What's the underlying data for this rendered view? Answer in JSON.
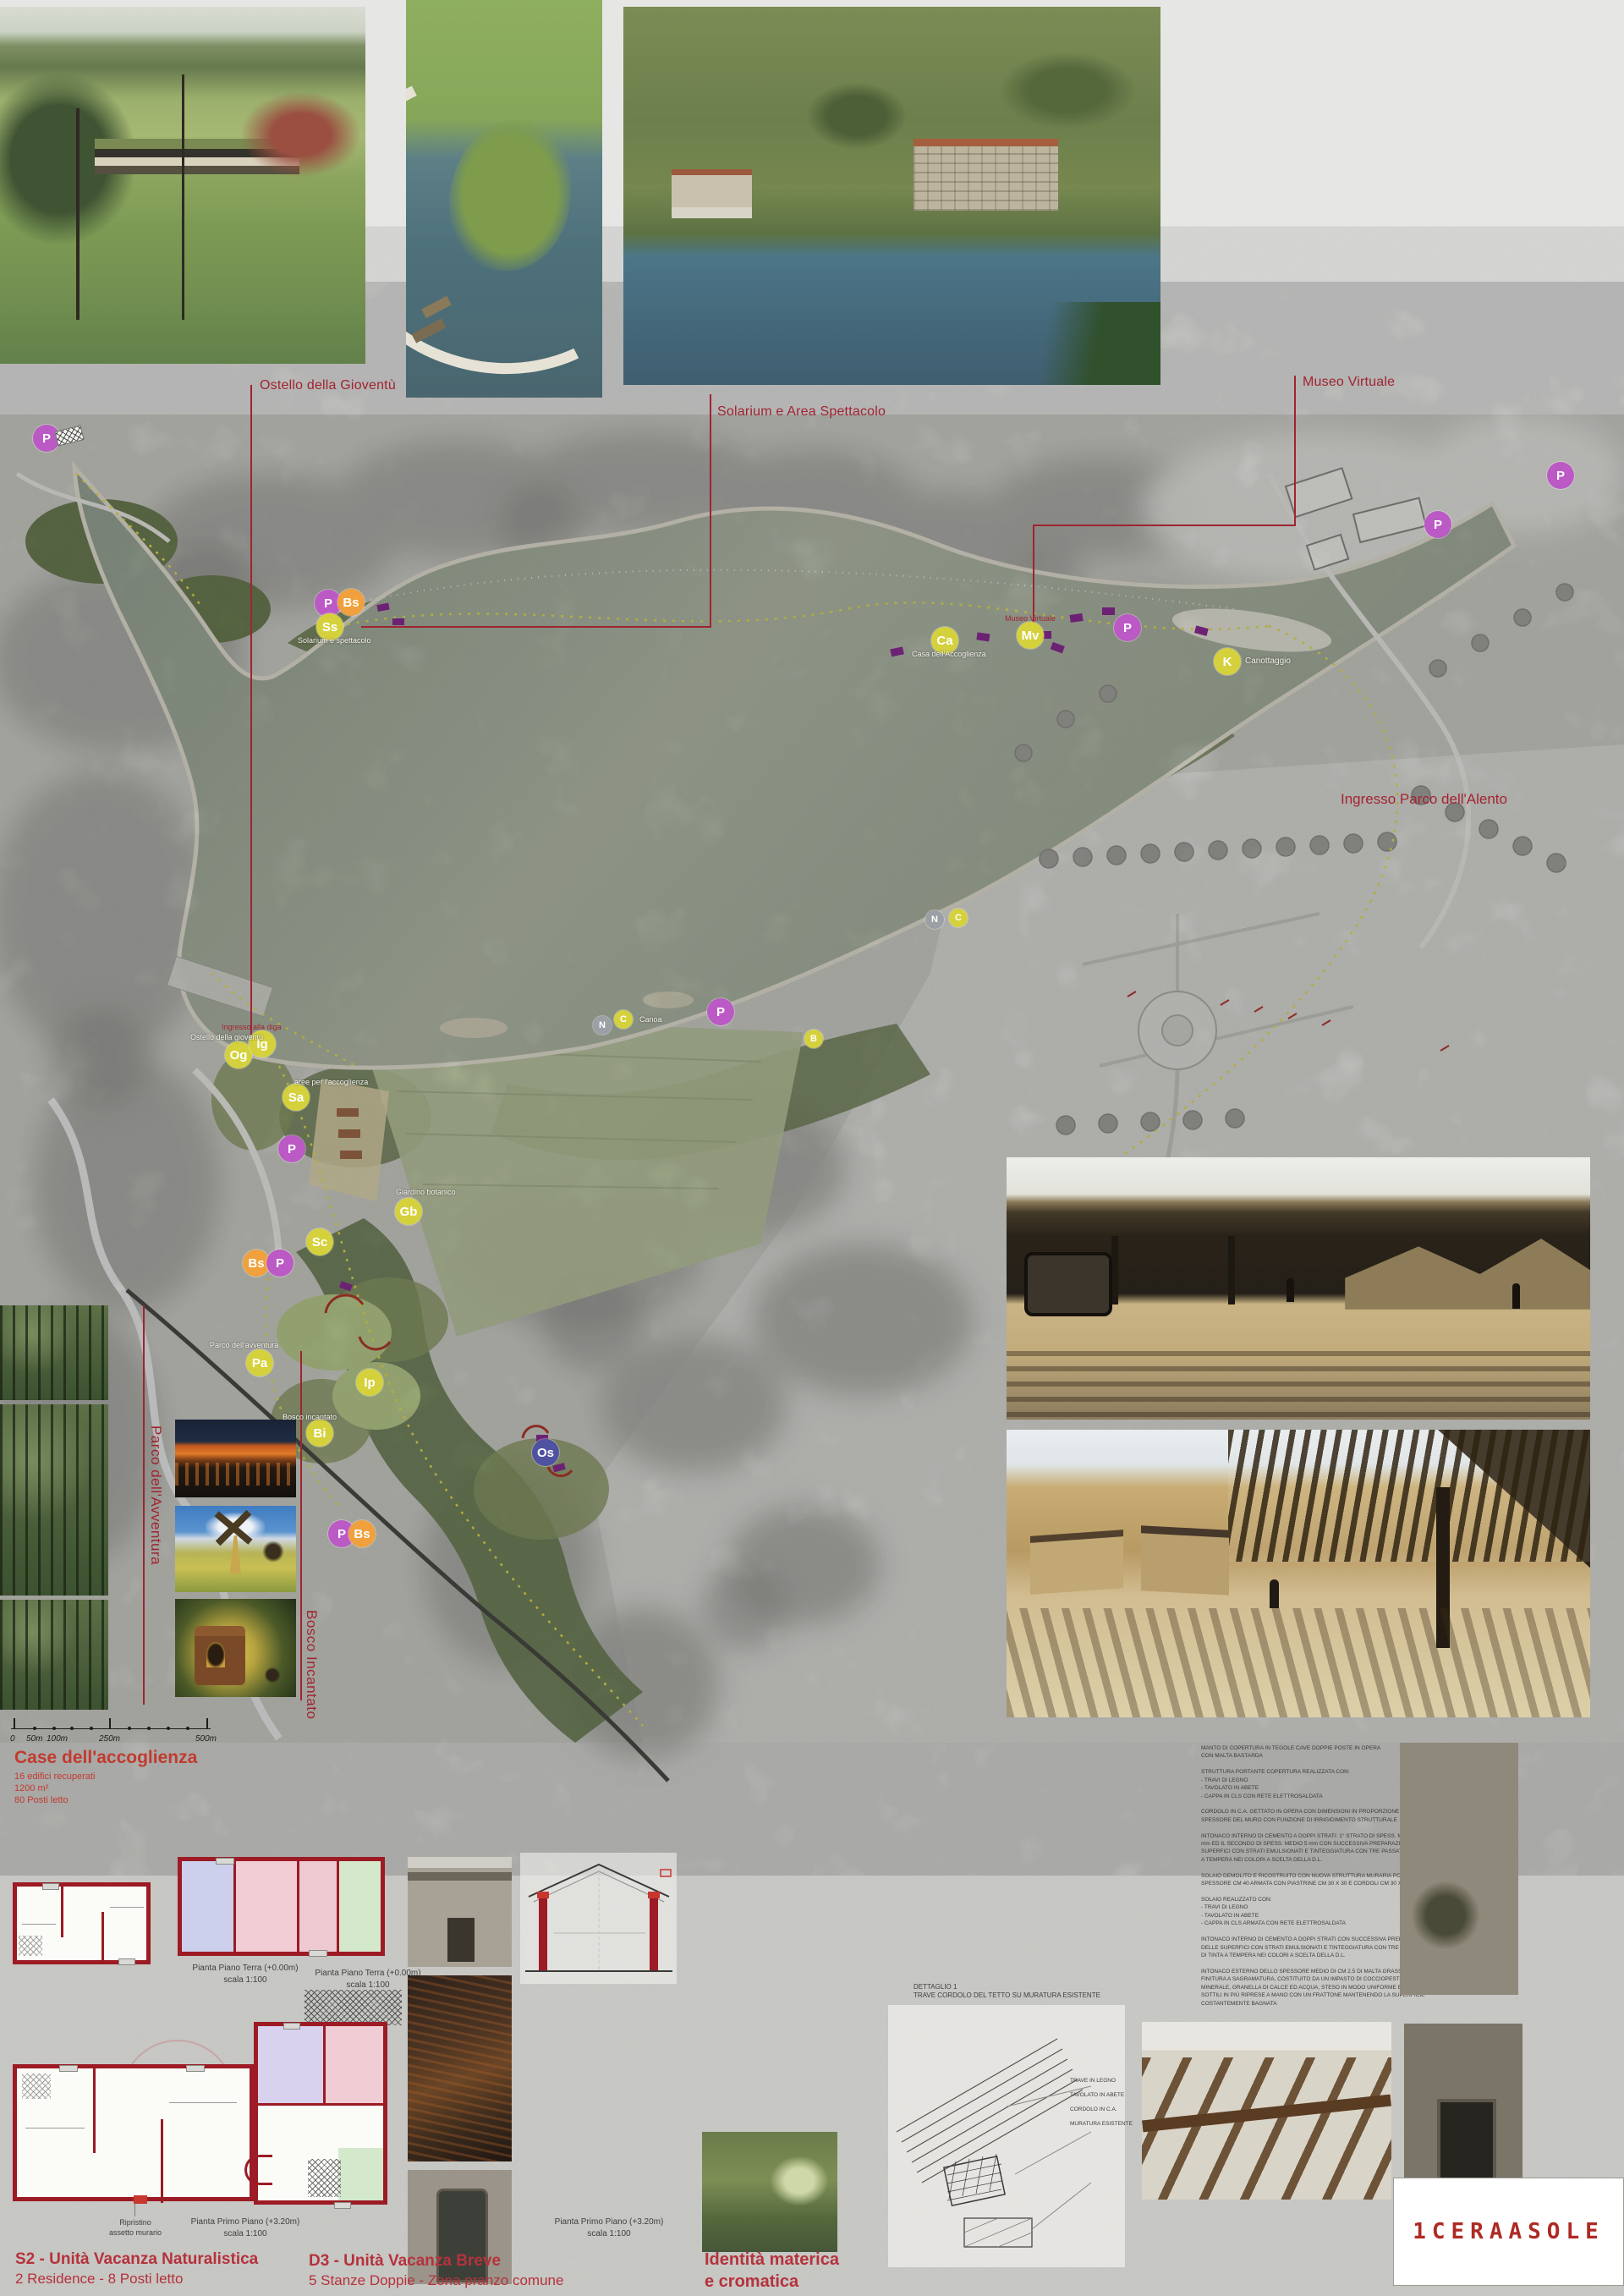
{
  "top_captions": {
    "ostello": "Ostello della Gioventù",
    "solarium": "Solarium e Area Spettacolo",
    "museo": "Museo Virtuale"
  },
  "map": {
    "entrance_label": "Ingresso Parco dell'Alento",
    "markers": [
      "P",
      "P",
      "P",
      "P",
      "Bs",
      "Ss",
      "Ca",
      "Mv",
      "P",
      "K",
      "N",
      "C",
      "N",
      "C",
      "P",
      "B",
      "Og",
      "Ig",
      "Sa",
      "P",
      "Sc",
      "Gb",
      "Bs",
      "P",
      "Pa",
      "Ip",
      "Bi",
      "Os",
      "P",
      "Bs"
    ],
    "small_labels": [
      "Solarium e spettacolo",
      "Casa dell'Accoglienza",
      "Museo Virtuale",
      "Canottaggio",
      "Canoa",
      "Ingresso alla diga",
      "Ostello della gioventù",
      "aree per l'accoglienza",
      "Giardino botanico",
      "Parco dell'avventura",
      "Bosco incantato"
    ],
    "side_labels": {
      "adventure": "Parco dell'Avventura",
      "enchanted": "Bosco Incantato"
    }
  },
  "scalebar": {
    "labels": [
      "0",
      "50m",
      "100m",
      "250m",
      "500m"
    ]
  },
  "accoglienza": {
    "title": "Case dell'accoglienza",
    "line1": "16 edifici recuperati",
    "line2": "1200 m²",
    "line3": "80 Posti letto"
  },
  "plans": {
    "pt": "Pianta Piano Terra (+0.00m)",
    "pp": "Pianta Primo Piano (+3.20m)",
    "scale": "scala 1:100",
    "ripristino": "Ripristino\nassetto murario",
    "ripristino_short": "Ripristino"
  },
  "units": {
    "s2_title": "S2 - Unità Vacanza Naturalistica",
    "s2_sub": "2 Residence - 8 Posti letto",
    "d3_title": "D3 - Unità Vacanza Breve",
    "d3_sub": "5 Stanze Doppie - Zona pranzo comune"
  },
  "identity": {
    "title": "Identità materica\ne cromatica",
    "watermark": "Os"
  },
  "detail": {
    "caption": "DETTAGLIO 1\nTRAVE CORDOLO DEL TETTO SU MURATURA ESISTENTE",
    "notes": "TRAVE IN LEGNO\nTAVOLATO IN ABETE\nCORDOLO IN C.A.\nMURATURA ESISTENTE"
  },
  "specs": {
    "text": "MANTO DI COPERTURA IN TEGOLE CAVE DOPPIE POSTE IN OPERA\nCON MALTA BASTARDA\n\nSTRUTTURA PORTANTE COPERTURA REALIZZATA CON:\n- TRAVI DI LEGNO\n- TAVOLATO IN ABETE\n- CAPPA IN CLS CON RETE ELETTROSALDATA\n\nCORDOLO IN C.A. GETTATO IN OPERA CON DIMENSIONI IN PROPORZIONE ALLO SPESSORE DEL MURO CON FUNZIONE DI IRRIGIDIMENTO STRUTTURALE\n\nINTONACO INTERNO DI CEMENTO A DOPPI STRATI: 1° STRATO DI SPESS. MEDIO 10 mm ED IL SECONDO DI SPESS. MEDIO 5 mm CON SUCCESSIVA PREPARAZIONE DELLE SUPERFICI CON STRATI EMULSIONATI E TINTEGGIATURA CON TRE PASSATE DI TINTA A TEMPERA NEI COLORI A SCELTA DELLA D.L.\n\nSOLAIO DEMOLITO E RICOSTRUITO CON NUOVA STRUTTURA MURARIA PORTANTE SPESSORE CM 40 ARMATA CON PIASTRINE CM 30 X 30 E CORDOLI CM 30 X 30\n\nSOLAIO REALIZZATO CON:\n- TRAVI DI LEGNO\n- TAVOLATO IN ABETE\n- CAPPA IN CLS ARMATA CON RETE ELETTROSALDATA\n\nINTONACO INTERNO DI CEMENTO A DOPPI STRATI CON SUCCESSIVA PREPARAZIONE DELLE SUPERFICI CON STRATI EMULSIONATI E TINTEGGIATURA CON TRE PASSATE DI TINTA A TEMPERA NEI COLORI A SCELTA DELLA D.L.\n\nINTONACO ESTERNO DELLO SPESSORE MEDIO DI CM 2.5 DI MALTA GRASSELLO CON FINITURA A SAGRAMATURA, COSTITUITO DA UN IMPASTO DI COCCIOPESTO A TERRA MINERALE, GRANELLA DI CALCE ED ACQUA, STESO IN MODO UNIFORME ED A STRATI SOTTILI IN PIÙ RIPRESE A MANO CON UN FRATTONE MANTENENDO LA SUPERFICIE COSTANTEMENTE BAGNATA"
  },
  "logo": {
    "text": "1CERAASOLE"
  },
  "colors": {
    "accent_red": "#9f2430",
    "heading_red": "#c23a2e",
    "marker_yellow": "#d5d13d",
    "marker_purple": "#bb59c5",
    "marker_orange": "#f0a03c",
    "marker_blue": "#4f52a0",
    "lake": "#a9b2a0"
  }
}
